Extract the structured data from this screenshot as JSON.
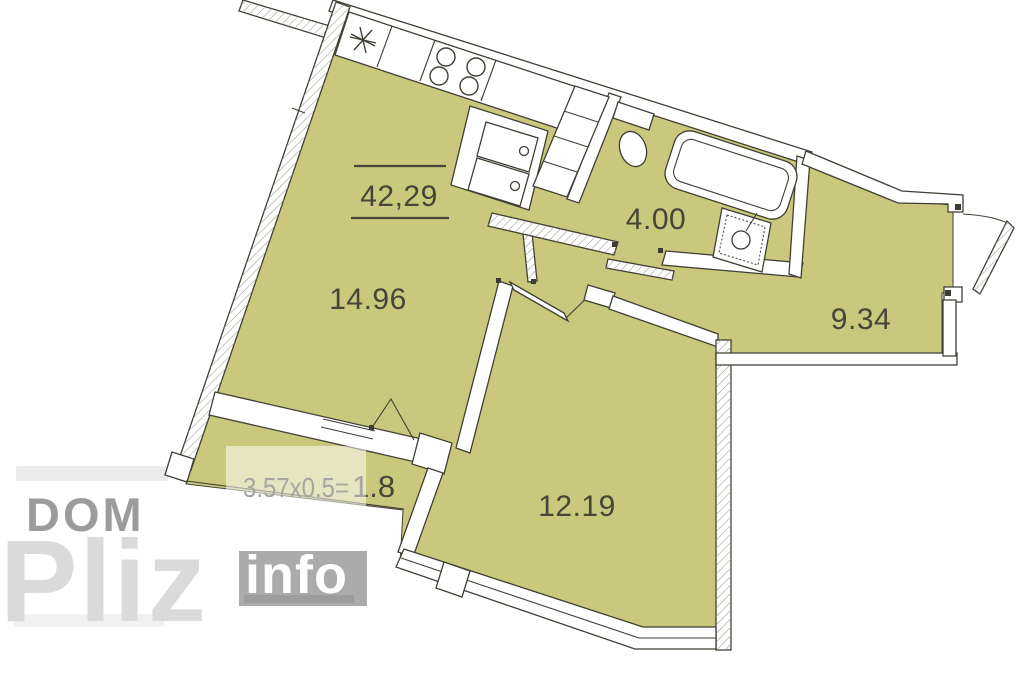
{
  "plan": {
    "total_area": "42,29",
    "rooms": [
      {
        "name": "living-kitchen",
        "label": "14.96"
      },
      {
        "name": "bathroom",
        "label": "4.00"
      },
      {
        "name": "hallway",
        "label": "9.34"
      },
      {
        "name": "bedroom",
        "label": "12.19"
      },
      {
        "name": "balcony",
        "label_formula": "3.57x0.5=",
        "label_value": "1.8"
      }
    ],
    "fixtures": [
      "star-vent-icon",
      "stove-burners-icon",
      "kitchen-sink-icon",
      "cabinet-shaft-icon",
      "toilet-icon",
      "bathtub-icon",
      "washbasin-icon",
      "entrance-door-icon",
      "bathroom-door-icon",
      "bedroom-door-icon",
      "balcony-door-icon",
      "window-icon"
    ],
    "colors": {
      "room_fill": "#c9c87c",
      "wall_line": "#3f3f35",
      "label_text": "#45453a",
      "hatch_line": "#9a9a8e",
      "watermark_gray": "#9c9c9c",
      "watermark_light": "#dadada",
      "watermark_box": "#ababab"
    }
  },
  "watermark": {
    "brand_top": "DOM",
    "brand_main": "Pliz",
    "brand_suffix": "info"
  }
}
